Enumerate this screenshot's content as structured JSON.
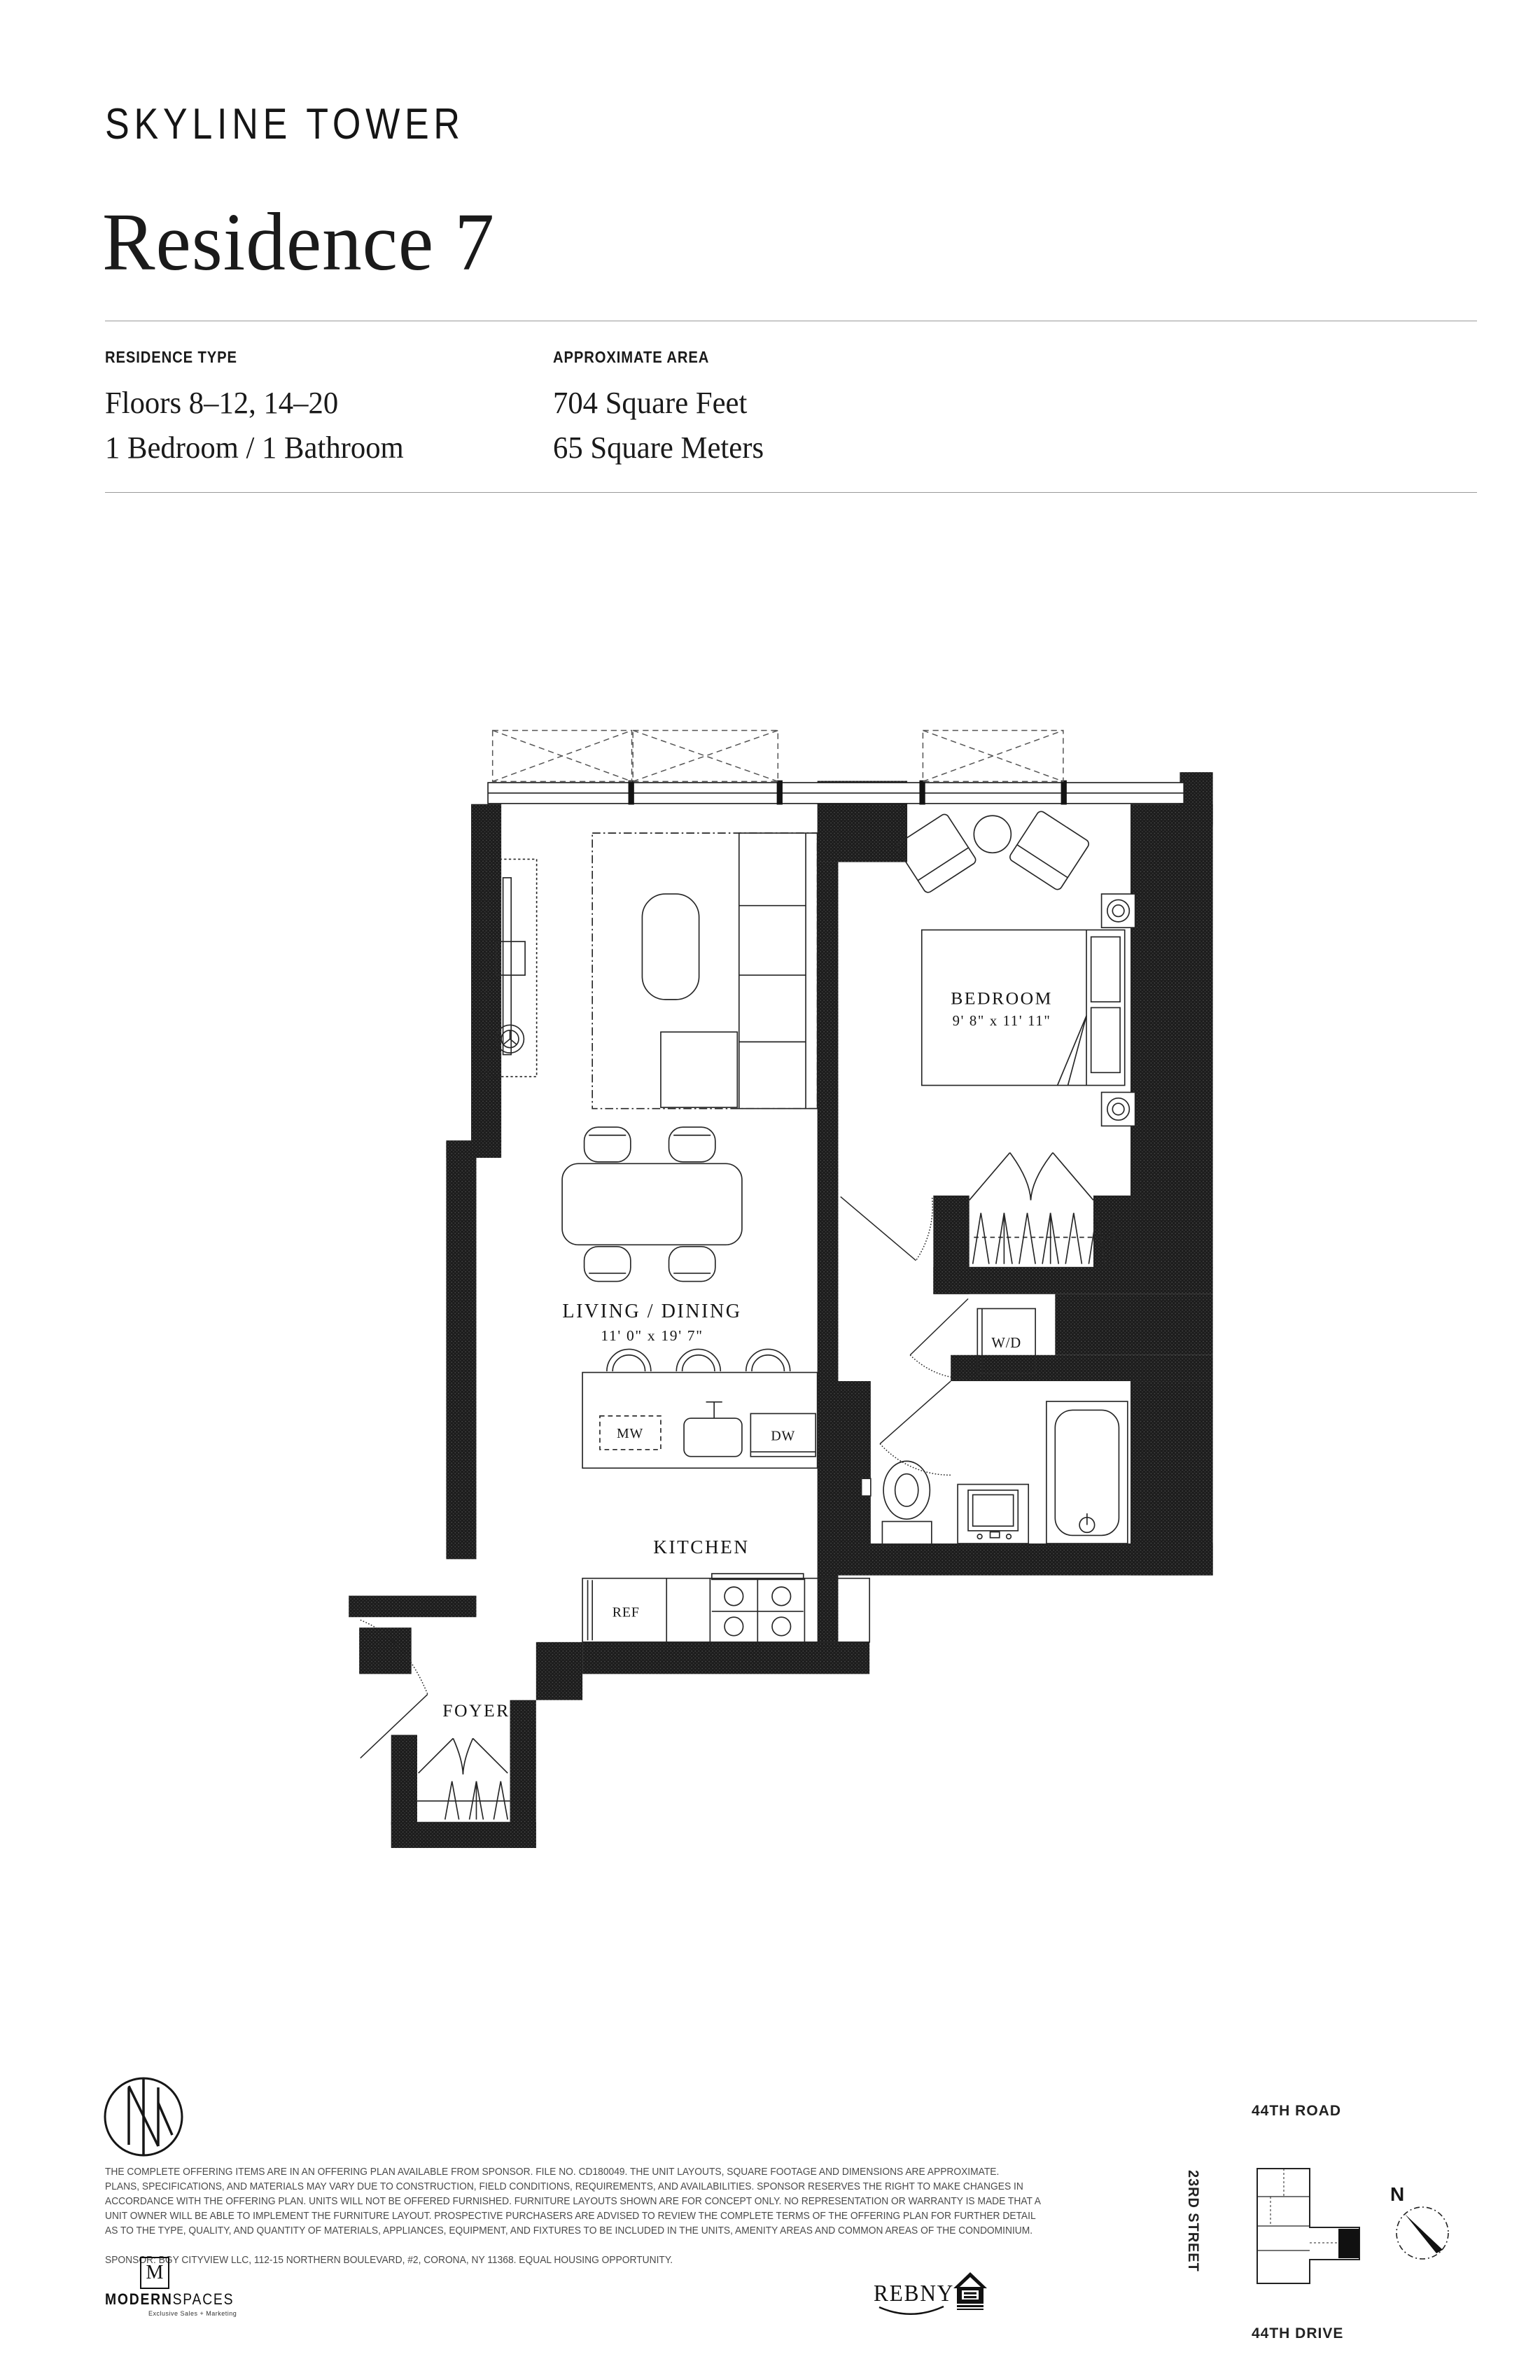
{
  "header": {
    "brand": "SKYLINE TOWER",
    "title": "Residence 7"
  },
  "info": {
    "residence_type": {
      "label": "RESIDENCE TYPE",
      "lines": [
        "Floors 8–12, 14–20",
        "1 Bedroom / 1 Bathroom"
      ]
    },
    "approximate_area": {
      "label": "APPROXIMATE AREA",
      "lines": [
        "704 Square Feet",
        "65 Square Meters"
      ]
    }
  },
  "floorplan": {
    "living_dining": {
      "name": "LIVING / DINING",
      "dims": "11' 0\" x 19' 7\""
    },
    "bedroom": {
      "name": "BEDROOM",
      "dims": "9' 8\" x 11' 11\""
    },
    "kitchen": {
      "name": "KITCHEN"
    },
    "foyer": {
      "name": "FOYER"
    },
    "labels": {
      "mw": "MW",
      "dw": "DW",
      "ref": "REF",
      "wd": "W/D"
    }
  },
  "legal": {
    "lines": [
      "THE COMPLETE OFFERING ITEMS ARE IN AN OFFERING PLAN AVAILABLE FROM SPONSOR. FILE NO. CD180049. THE UNIT LAYOUTS, SQUARE FOOTAGE AND DIMENSIONS ARE APPROXIMATE.",
      "PLANS, SPECIFICATIONS, AND MATERIALS MAY VARY DUE TO CONSTRUCTION, FIELD CONDITIONS, REQUIREMENTS, AND AVAILABILITIES. SPONSOR RESERVES THE RIGHT TO MAKE CHANGES IN",
      "ACCORDANCE WITH THE OFFERING PLAN. UNITS WILL NOT BE OFFERED FURNISHED. FURNITURE LAYOUTS SHOWN ARE FOR CONCEPT ONLY. NO REPRESENTATION OR WARRANTY IS MADE THAT A",
      "UNIT OWNER WILL BE ABLE TO IMPLEMENT THE FURNITURE LAYOUT. PROSPECTIVE PURCHASERS ARE ADVISED TO REVIEW THE COMPLETE TERMS OF THE OFFERING PLAN FOR FURTHER DETAIL",
      "AS TO THE TYPE, QUALITY, AND QUANTITY OF MATERIALS, APPLIANCES, EQUIPMENT, AND FIXTURES TO BE INCLUDED IN THE UNITS, AMENITY AREAS AND COMMON AREAS OF THE CONDOMINIUM."
    ],
    "sponsor": "SPONSOR: BGY CITYVIEW LLC, 112-15 NORTHERN BOULEVARD, #2, CORONA, NY 11368. EQUAL HOUSING OPPORTUNITY."
  },
  "brokers": {
    "modernspaces": {
      "monogram": "M",
      "bold": "MODERN",
      "light": "SPACES",
      "tagline": "Exclusive Sales + Marketing"
    },
    "rebny": "REBNY"
  },
  "map": {
    "top": "44TH ROAD",
    "left": "23RD STREET",
    "bottom": "44TH DRIVE",
    "compass": "N"
  }
}
